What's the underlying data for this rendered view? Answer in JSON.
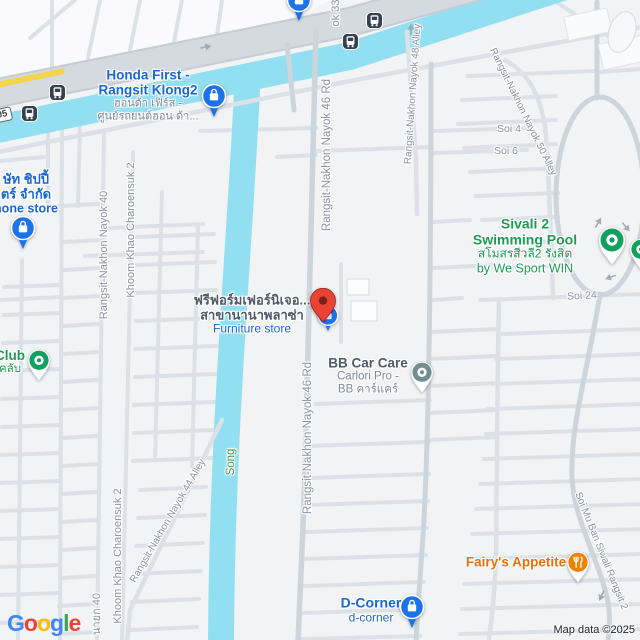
{
  "map": {
    "attribution": "Map data ©2025",
    "route_shield": {
      "text": "05",
      "x": -7,
      "y": 108,
      "rot": -12
    },
    "logo_letters": [
      {
        "ch": "G",
        "color": "#4285F4"
      },
      {
        "ch": "o",
        "color": "#EA4335"
      },
      {
        "ch": "o",
        "color": "#FBBC05"
      },
      {
        "ch": "g",
        "color": "#4285F4"
      },
      {
        "ch": "l",
        "color": "#34A853"
      },
      {
        "ch": "e",
        "color": "#EA4335"
      }
    ],
    "colors": {
      "background": "#F2F3F5",
      "water": "#93DFF2",
      "highway": "#D5DAE0",
      "highway_edge": "#C5CCD3",
      "road": "#DCE1E8",
      "road_main": "#CCD4DC",
      "yellow_road": "#F2D44D",
      "road_label": "#8A94A2",
      "poi_blue": "#1A73E8",
      "poi_green": "#12A05F",
      "poi_teal": "#6F8F93",
      "poi_orange": "#EE8100",
      "marker_red": "#EA4335",
      "transit_dark": "#35414F"
    },
    "road_labels": [
      {
        "text": "Rangsit-Nakhon Nayok 46 Rd",
        "x": 327,
        "y": 155,
        "rot": -90,
        "size": 11.5,
        "cls": "c-road"
      },
      {
        "text": "Rangsit-Nakhon Nayok 46 Rd",
        "x": 308,
        "y": 438,
        "rot": -90,
        "size": 11.5,
        "cls": "c-road"
      },
      {
        "text": "Rangsit-Nakhon Nayok 40",
        "x": 104,
        "y": 255,
        "rot": -90,
        "size": 11,
        "cls": "c-road"
      },
      {
        "text": "นายก 40",
        "x": 96,
        "y": 614,
        "rot": -90,
        "size": 11,
        "cls": "c-road"
      },
      {
        "text": "Khoom Khao Charoensuk 2",
        "x": 131,
        "y": 230,
        "rot": -90,
        "size": 11,
        "cls": "c-road"
      },
      {
        "text": "Khoom Khao Charoensuk 2",
        "x": 118,
        "y": 556,
        "rot": -90,
        "size": 11,
        "cls": "c-road"
      },
      {
        "text": "Rangsit-Nakhon Nayok 48 Alley",
        "x": 413,
        "y": 94,
        "rot": -86,
        "size": 10,
        "cls": "c-road"
      },
      {
        "text": "Rangsit-Nakhon Nayok 50 Alley",
        "x": 523,
        "y": 112,
        "rot": 64,
        "size": 10,
        "cls": "c-road"
      },
      {
        "text": "Rangsit-Nakhon Nayok 44 Alley",
        "x": 168,
        "y": 521,
        "rot": -60,
        "size": 10,
        "cls": "c-road"
      },
      {
        "text": "Soi Mu Ban Siwali Rangsit 2",
        "x": 601,
        "y": 551,
        "rot": 68,
        "size": 10,
        "cls": "c-road"
      },
      {
        "text": "ok 33",
        "x": 336,
        "y": 13,
        "rot": -90,
        "size": 11,
        "cls": "c-road"
      },
      {
        "text": "Soi 4",
        "x": 509,
        "y": 129,
        "rot": 0,
        "size": 10.5,
        "cls": "c-road"
      },
      {
        "text": "Soi 6",
        "x": 506,
        "y": 151,
        "rot": 0,
        "size": 10.5,
        "cls": "c-road"
      },
      {
        "text": "Soi 24",
        "x": 582,
        "y": 296,
        "rot": -3,
        "size": 10.5,
        "cls": "c-road"
      },
      {
        "text": "Song",
        "x": 231,
        "y": 462,
        "rot": -90,
        "size": 11.5,
        "cls": "c-water"
      }
    ],
    "pois": [
      {
        "id": "honda-first",
        "pin": {
          "icon": "shopping-bag-pin",
          "color": "#1A73E8",
          "x": 214,
          "y": 96
        },
        "label": {
          "x": 148,
          "y": 95,
          "lines": [
            {
              "text": "Honda First -",
              "cls": "c-blue",
              "size": 13.5,
              "bold": true
            },
            {
              "text": "Rangsit Klong2",
              "cls": "c-blue",
              "size": 13.5,
              "bold": true
            },
            {
              "text": "ฮอนด้า เฟิร์ส -",
              "cls": "c-grey2",
              "size": 11
            },
            {
              "text": "ศูนย์รถยนต์ฮอน ด้า...",
              "cls": "c-grey2",
              "size": 11
            }
          ]
        }
      },
      {
        "id": "phone-store",
        "pin": {
          "icon": "shopping-bag-pin",
          "color": "#1A73E8",
          "x": 23,
          "y": 228
        },
        "label": {
          "x": 26,
          "y": 194,
          "lines": [
            {
              "text": "ษัท ชิปปี้",
              "cls": "c-blue",
              "size": 13,
              "bold": true
            },
            {
              "text": "ตร์ จำกัด",
              "cls": "c-blue",
              "size": 13,
              "bold": true
            },
            {
              "text": "hone store",
              "cls": "c-blue",
              "size": 12.5,
              "bold": true
            }
          ]
        }
      },
      {
        "id": "club",
        "pin": {
          "icon": "dot-pin",
          "color": "#12A05F",
          "x": 39,
          "y": 360
        },
        "label": {
          "x": 10,
          "y": 362,
          "lines": [
            {
              "text": "Club",
              "cls": "c-green",
              "size": 13.5,
              "bold": true
            },
            {
              "text": "คลับ",
              "cls": "c-green",
              "size": 11.5
            }
          ]
        }
      },
      {
        "id": "furniture-store",
        "pin": {
          "icon": "shopping-bag-circle",
          "color": "#1A73E8",
          "x": 328,
          "y": 315
        },
        "label": {
          "x": 252,
          "y": 315,
          "lines": [
            {
              "text": "ฟรีฟอร์มเฟอร์นิเจอ...",
              "cls": "c-dark",
              "size": 13,
              "bold": true
            },
            {
              "text": "สาขานานาพลาซ่า",
              "cls": "c-dark",
              "size": 13,
              "bold": true
            },
            {
              "text": "Furniture store",
              "cls": "c-blue",
              "size": 12
            }
          ]
        }
      },
      {
        "id": "bb-car-care",
        "pin": {
          "icon": "dot-pin",
          "color": "#6F8F93",
          "x": 422,
          "y": 372
        },
        "label": {
          "x": 368,
          "y": 376,
          "lines": [
            {
              "text": "BB Car Care",
              "cls": "c-dark",
              "size": 13.5,
              "bold": true
            },
            {
              "text": "Carlori Pro -",
              "cls": "c-grey2",
              "size": 11.5
            },
            {
              "text": "BB คาร์แคร์",
              "cls": "c-grey2",
              "size": 11.5
            }
          ]
        }
      },
      {
        "id": "sivali-swimming-pool",
        "pin": {
          "icon": "dot-pin-lg",
          "color": "#12A05F",
          "x": 612,
          "y": 240
        },
        "label": {
          "x": 525,
          "y": 246,
          "lines": [
            {
              "text": "Sivali 2 Swimming Pool",
              "cls": "c-green",
              "size": 14,
              "bold": true
            },
            {
              "text": "สโมสรสีวลี2 รังสิต",
              "cls": "c-green",
              "size": 12
            },
            {
              "text": "by We Sport WIN",
              "cls": "c-green",
              "size": 12.5
            }
          ]
        }
      },
      {
        "id": "fairys-appetite",
        "pin": {
          "icon": "restaurant-pin",
          "color": "#EE8100",
          "x": 578,
          "y": 562
        },
        "label": {
          "x": 516,
          "y": 562,
          "lines": [
            {
              "text": "Fairy's Appetite",
              "cls": "c-orange",
              "size": 13.5,
              "bold": true
            }
          ]
        }
      },
      {
        "id": "d-corner",
        "pin": {
          "icon": "shopping-bag-pin",
          "color": "#1A73E8",
          "x": 412,
          "y": 607
        },
        "label": {
          "x": 371,
          "y": 610,
          "lines": [
            {
              "text": "D-Corner",
              "cls": "c-blue",
              "size": 14,
              "bold": true
            },
            {
              "text": "d-corner",
              "cls": "c-blue",
              "size": 12
            }
          ]
        }
      },
      {
        "id": "poi-cut-top",
        "pin": {
          "icon": "shopping-bag-pin",
          "color": "#1A73E8",
          "x": 299,
          "y": 0
        }
      },
      {
        "id": "poi-cut-right",
        "pin": {
          "icon": "dot-pin",
          "color": "#12A05F",
          "x": 641,
          "y": 249
        }
      }
    ],
    "selected_marker": {
      "icon": "red-marker",
      "x": 323,
      "y": 322
    },
    "bus_stops": [
      {
        "x": 29,
        "y": 113
      },
      {
        "x": 57,
        "y": 92
      },
      {
        "x": 350,
        "y": 41
      },
      {
        "x": 374,
        "y": 20
      }
    ],
    "one_way_arrows": [
      {
        "x": 205,
        "y": 42,
        "rot": -12
      },
      {
        "x": 406,
        "y": 29,
        "rot": -90
      },
      {
        "x": 594,
        "y": 220,
        "rot": -60
      },
      {
        "x": 630,
        "y": 224,
        "rot": 50
      },
      {
        "x": 612,
        "y": 282,
        "rot": 160
      },
      {
        "x": 606,
        "y": 598,
        "rot": 115
      }
    ]
  }
}
